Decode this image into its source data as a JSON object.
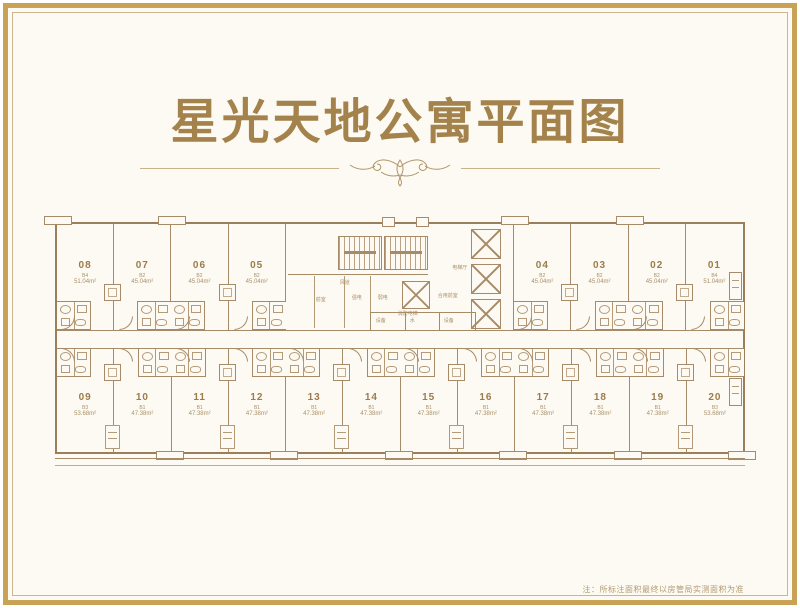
{
  "page": {
    "title": "星光天地公寓平面图",
    "note": "注：所标注面积最终以房管局实测面积为准"
  },
  "colors": {
    "frame_gold": "#c8a355",
    "frame_inner_tan": "#cdb68e",
    "background_cream": "#fcfaf2",
    "plan_line_brown": "#a78a67",
    "title_gold": "#a3824c",
    "label_brown": "#9d7b4b"
  },
  "plan": {
    "top_left_units": [
      {
        "number": "08",
        "type": "B4",
        "area": "51.04m²"
      },
      {
        "number": "07",
        "type": "B2",
        "area": "45.04m²"
      },
      {
        "number": "06",
        "type": "B2",
        "area": "45.04m²"
      },
      {
        "number": "05",
        "type": "B2",
        "area": "45.04m²"
      }
    ],
    "top_right_units": [
      {
        "number": "04",
        "type": "B2",
        "area": "45.04m²"
      },
      {
        "number": "03",
        "type": "B2",
        "area": "45.04m²"
      },
      {
        "number": "02",
        "type": "B2",
        "area": "45.04m²"
      },
      {
        "number": "01",
        "type": "B4",
        "area": "51.04m²"
      }
    ],
    "bottom_units": [
      {
        "number": "09",
        "type": "B3",
        "area": "53.68m²"
      },
      {
        "number": "10",
        "type": "B1",
        "area": "47.38m²"
      },
      {
        "number": "11",
        "type": "B1",
        "area": "47.38m²"
      },
      {
        "number": "12",
        "type": "B1",
        "area": "47.38m²"
      },
      {
        "number": "13",
        "type": "B1",
        "area": "47.38m²"
      },
      {
        "number": "14",
        "type": "B1",
        "area": "47.38m²"
      },
      {
        "number": "15",
        "type": "B1",
        "area": "47.38m²"
      },
      {
        "number": "16",
        "type": "B1",
        "area": "47.38m²"
      },
      {
        "number": "17",
        "type": "B1",
        "area": "47.38m²"
      },
      {
        "number": "18",
        "type": "B1",
        "area": "47.38m²"
      },
      {
        "number": "19",
        "type": "B1",
        "area": "47.38m²"
      },
      {
        "number": "20",
        "type": "B3",
        "area": "53.68m²"
      }
    ],
    "core_labels": {
      "front_room": "前室",
      "air_duct": "风道",
      "strong_elec": "强电",
      "weak_elec": "弱电",
      "fire_elevator": "消防电梯",
      "shared_front_room": "合用前室",
      "elevator_hall": "电梯厅",
      "equipment": "设备",
      "water": "水",
      "equipment2": "设备"
    }
  }
}
